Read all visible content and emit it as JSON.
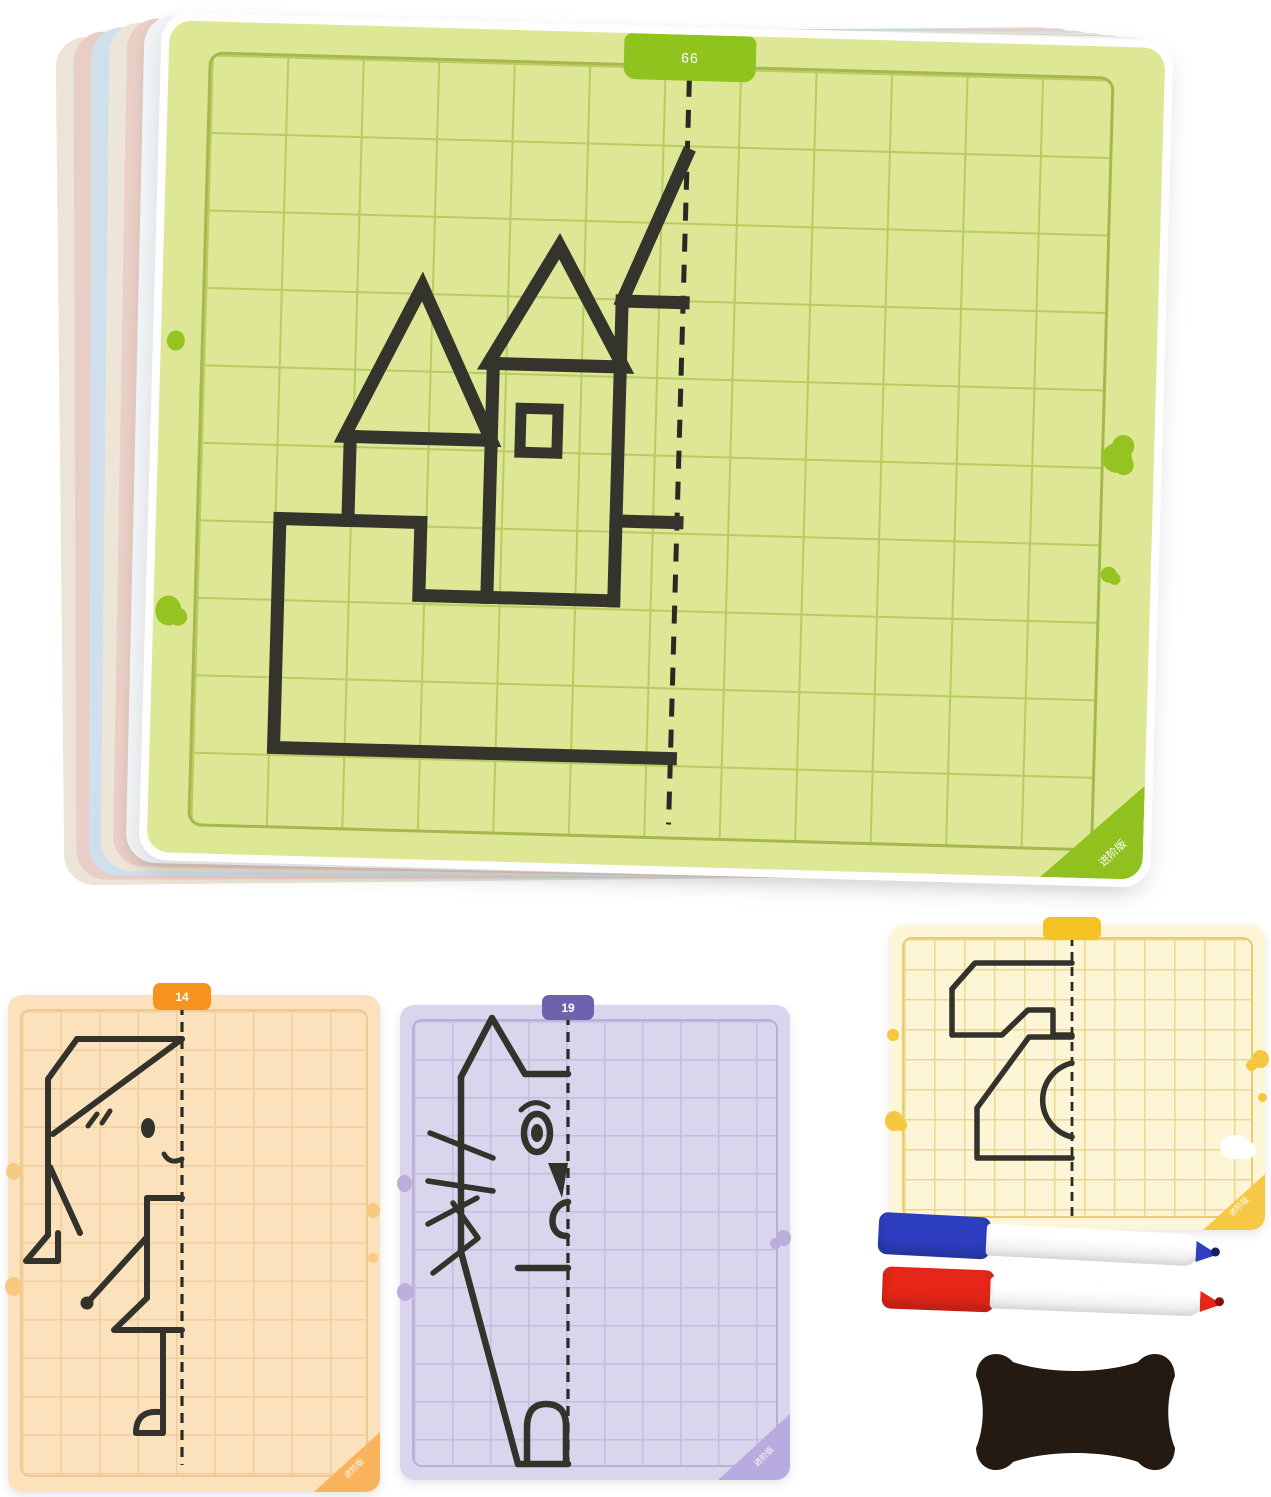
{
  "product": {
    "description": "Symmetry grid drawing card set with stack of dry-erase boards, three practice cards, two markers and a bone-shaped eraser"
  },
  "main_card": {
    "tab_label": "66",
    "corner_label": "进阶版",
    "drawing_name": "castle half-drawing with mirror fold line",
    "face_color": "#dde795",
    "accent_color": "#8fc31e"
  },
  "orange_card": {
    "tab_label": "14",
    "corner_label": "进阶版",
    "drawing_name": "girl half-drawing with mirror fold line",
    "face_color": "#fbe2bd",
    "accent_color": "#f6921e"
  },
  "purple_card": {
    "tab_label": "19",
    "corner_label": "进阶版",
    "drawing_name": "cat half-drawing with mirror fold line",
    "face_color": "#dad5ed",
    "accent_color": "#6f61ad"
  },
  "yellow_card": {
    "tab_label": "",
    "corner_label": "进阶版",
    "drawing_name": "sewing-machine half-drawing with mirror fold line",
    "face_color": "#fdf6d6",
    "accent_color": "#f4c224"
  },
  "markers": [
    {
      "name": "blue dry-erase marker",
      "color": "#2e3ec0"
    },
    {
      "name": "red dry-erase marker",
      "color": "#e52618"
    }
  ],
  "eraser": {
    "name": "bone-shaped felt eraser",
    "color": "#241a12"
  }
}
